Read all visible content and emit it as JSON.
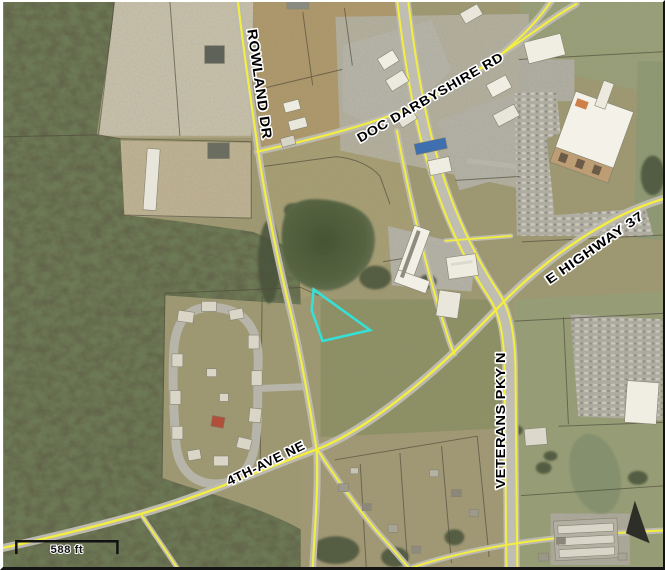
{
  "map": {
    "description": "Aerial parcel map with highlighted property outline",
    "road_labels": [
      {
        "id": "rowland-dr",
        "text": "ROWLAND DR"
      },
      {
        "id": "doc-darbyshire-rd",
        "text": "DOC DARBYSHIRE RD"
      },
      {
        "id": "e-highway-37",
        "text": "E HIGHWAY 37"
      },
      {
        "id": "veterans-pky-n",
        "text": "VETERANS PKY N"
      },
      {
        "id": "4th-ave-ne",
        "text": "4TH-AVE NE"
      }
    ],
    "scale_bar": {
      "label": "588 ft"
    },
    "highlight": {
      "color": "#35e0d6"
    },
    "colors": {
      "road_line": "#f4ee3f",
      "road_pavement": "#bdbbb0",
      "label_text": "#000000",
      "label_halo": "#ffffff",
      "water": "#55643f",
      "forest": "#5f6249"
    }
  }
}
